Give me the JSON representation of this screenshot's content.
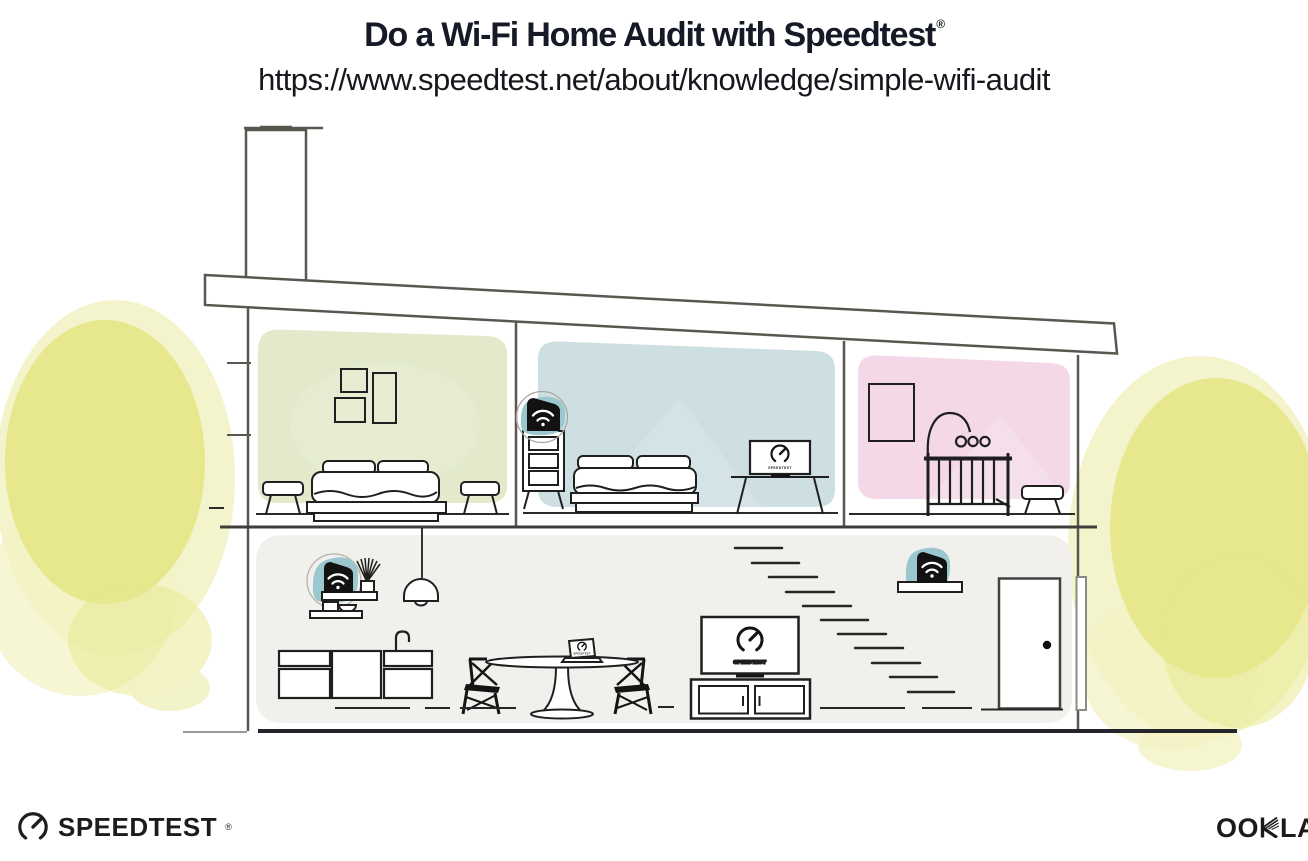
{
  "header": {
    "title": "Do a Wi-Fi Home Audit with Speedtest",
    "registered_mark": "®",
    "url": "https://www.speedtest.net/about/knowledge/simple-wifi-audit"
  },
  "illustration": {
    "rooms": [
      {
        "name": "green-bedroom",
        "contents": "wall frames, double bed, two stools"
      },
      {
        "name": "blue-bedroom",
        "contents": "dresser with wifi mesh point, double bed, tv with speedtest screen"
      },
      {
        "name": "pink-nursery",
        "contents": "wall frame, crib with mobile, stool"
      },
      {
        "name": "downstairs-living-area",
        "contents": "shelf with wifi router, pendant lamp, kitchen cabinets, dining table with laptop running speedtest, two chairs, tv with speedtest screen on console, stairs, shelf with wifi mesh point, front door"
      }
    ],
    "wifi_devices": [
      {
        "icon": "wifi-icon",
        "location": "blue-bedroom-dresser"
      },
      {
        "icon": "wifi-icon",
        "location": "kitchen-shelf"
      },
      {
        "icon": "wifi-icon",
        "location": "stairs-shelf"
      }
    ]
  },
  "devices": {
    "speedtest_caption": "SPEEDTEST"
  },
  "footer": {
    "speedtest_logo": {
      "label": "SPEEDTEST",
      "registered": "®",
      "icon": "speedtest-gauge-icon"
    },
    "ookla_logo": {
      "label_left": "OO",
      "label_right": "LA",
      "registered": "®",
      "icon": "ookla-k-glyph"
    }
  },
  "colors": {
    "room_green": "#e2eacb",
    "room_blue": "#cedfe2",
    "room_pink": "#f5d8e8",
    "room_gray": "#f1f0ed",
    "accent_teal": "#9bc7cf",
    "tree_core": "#e7e78e",
    "tree_light": "#f2f2c3",
    "ink": "#1f1f1f",
    "structure": "#5a5751",
    "title_ink": "#151a26"
  }
}
